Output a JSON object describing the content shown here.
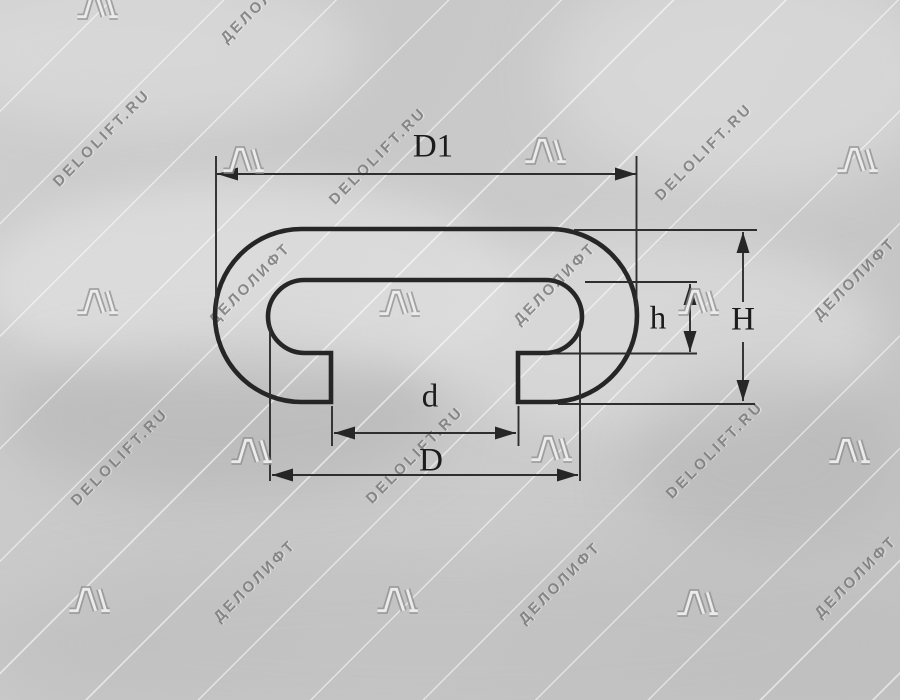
{
  "drawing": {
    "type": "handrail profile cross-section",
    "labels": {
      "outer_width": "D1",
      "total_height": "H",
      "lip_height": "h",
      "opening_width": "d",
      "lip_width": "D"
    }
  },
  "watermark": {
    "text_latin": "DELOLIFT.RU",
    "text_cyrillic": "ДЕЛОЛИФТ",
    "items": [
      {
        "t": "logo",
        "x": 98,
        "y": 6
      },
      {
        "t": "ru",
        "x": 262,
        "y": 2
      },
      {
        "t": "en",
        "x": 102,
        "y": 138
      },
      {
        "t": "logo",
        "x": 244,
        "y": 160
      },
      {
        "t": "en",
        "x": 378,
        "y": 156
      },
      {
        "t": "logo",
        "x": 546,
        "y": 151
      },
      {
        "t": "en",
        "x": 704,
        "y": 152
      },
      {
        "t": "logo",
        "x": 858,
        "y": 160
      },
      {
        "t": "logo",
        "x": 98,
        "y": 302
      },
      {
        "t": "ru",
        "x": 250,
        "y": 284
      },
      {
        "t": "logo",
        "x": 400,
        "y": 303
      },
      {
        "t": "ru",
        "x": 555,
        "y": 284
      },
      {
        "t": "logo",
        "x": 699,
        "y": 302
      },
      {
        "t": "ru",
        "x": 855,
        "y": 279
      },
      {
        "t": "en",
        "x": 120,
        "y": 457
      },
      {
        "t": "logo",
        "x": 252,
        "y": 451
      },
      {
        "t": "en",
        "x": 415,
        "y": 455
      },
      {
        "t": "logo",
        "x": 552,
        "y": 449
      },
      {
        "t": "en",
        "x": 715,
        "y": 450
      },
      {
        "t": "logo",
        "x": 850,
        "y": 451
      },
      {
        "t": "logo",
        "x": 90,
        "y": 600
      },
      {
        "t": "ru",
        "x": 255,
        "y": 581
      },
      {
        "t": "logo",
        "x": 398,
        "y": 600
      },
      {
        "t": "ru",
        "x": 560,
        "y": 583
      },
      {
        "t": "logo",
        "x": 698,
        "y": 603
      },
      {
        "t": "ru",
        "x": 856,
        "y": 577
      }
    ]
  },
  "colors": {
    "background": "#c8c8c8",
    "profile_line": "#262626",
    "dimension_line": "#2e2e2e",
    "label_text": "#1c1c1c",
    "watermark_gray": "#707070"
  }
}
